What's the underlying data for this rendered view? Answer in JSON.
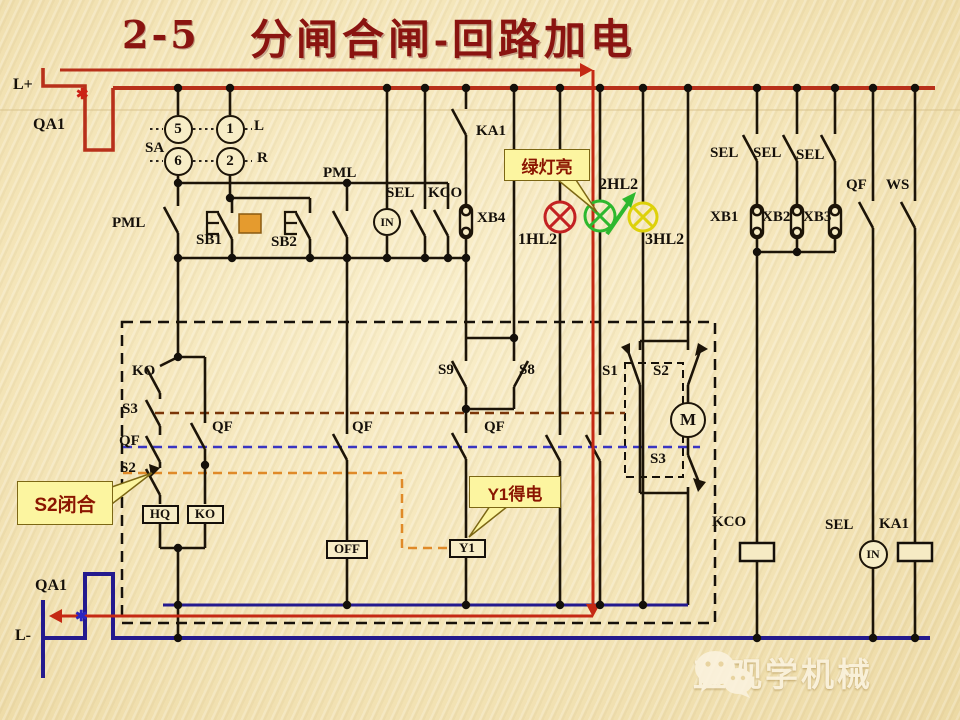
{
  "title": {
    "number": "2-5",
    "text": "分闸合闸-回路加电"
  },
  "callouts": {
    "green_lamp": "绿灯亮",
    "s2_closed": "S2闭合",
    "y1_energized": "Y1得电"
  },
  "watermark": {
    "text": "直观学机械",
    "icon": "wechat-icon"
  },
  "colors": {
    "background": "#f4e5b8",
    "title": "#8a1410",
    "positive_bus": "#b8301a",
    "negative_bus": "#241a8e",
    "wire": "#1c1408",
    "highlight_path": "#c52914",
    "callout_bg": "#fcf5a0",
    "callout_text": "#8b1500",
    "lamp_red": "#c32222",
    "lamp_green": "#2eb82e",
    "lamp_yellow": "#ddd10a",
    "dash_qf_link": "#3a35c2",
    "dash_s3_link": "#7a3508",
    "dash_s2_link": "#e08a28",
    "button_block": "#e59b2e"
  },
  "labels": [
    {
      "id": "l-plus",
      "text": "L+",
      "x": 13,
      "y": 77,
      "size": 16
    },
    {
      "id": "qa1-top",
      "text": "QA1",
      "x": 33,
      "y": 117,
      "size": 16
    },
    {
      "id": "sa",
      "text": "SA",
      "x": 145,
      "y": 141
    },
    {
      "id": "sa-pos-l",
      "text": "L",
      "x": 254,
      "y": 119
    },
    {
      "id": "sa-pos-r",
      "text": "R",
      "x": 257,
      "y": 151
    },
    {
      "id": "pml-left",
      "text": "PML",
      "x": 112,
      "y": 216
    },
    {
      "id": "sb1",
      "text": "SB1",
      "x": 196,
      "y": 233
    },
    {
      "id": "sb2",
      "text": "SB2",
      "x": 271,
      "y": 235
    },
    {
      "id": "pml-top",
      "text": "PML",
      "x": 323,
      "y": 166
    },
    {
      "id": "sel-mid",
      "text": "SEL",
      "x": 386,
      "y": 186
    },
    {
      "id": "kco-mid",
      "text": "KCO",
      "x": 428,
      "y": 186
    },
    {
      "id": "ka1-top",
      "text": "KA1",
      "x": 476,
      "y": 124
    },
    {
      "id": "xb4",
      "text": "XB4",
      "x": 477,
      "y": 211
    },
    {
      "id": "lamp1",
      "text": "1HL2",
      "x": 518,
      "y": 232,
      "size": 16
    },
    {
      "id": "lamp2",
      "text": "2HL2",
      "x": 599,
      "y": 177,
      "size": 16
    },
    {
      "id": "lamp3",
      "text": "3HL2",
      "x": 645,
      "y": 232,
      "size": 16
    },
    {
      "id": "sel-r1",
      "text": "SEL",
      "x": 710,
      "y": 146
    },
    {
      "id": "sel-r2",
      "text": "SEL",
      "x": 753,
      "y": 146
    },
    {
      "id": "sel-r3",
      "text": "SEL",
      "x": 796,
      "y": 148
    },
    {
      "id": "xb1",
      "text": "XB1",
      "x": 710,
      "y": 210
    },
    {
      "id": "xb2",
      "text": "XB2",
      "x": 762,
      "y": 210
    },
    {
      "id": "xb3",
      "text": "XB3",
      "x": 803,
      "y": 210
    },
    {
      "id": "qf-right",
      "text": "QF",
      "x": 846,
      "y": 178
    },
    {
      "id": "ws",
      "text": "WS",
      "x": 886,
      "y": 178
    },
    {
      "id": "ko-contact",
      "text": "KO",
      "x": 132,
      "y": 364
    },
    {
      "id": "s3-left",
      "text": "S3",
      "x": 122,
      "y": 402
    },
    {
      "id": "qf-left",
      "text": "QF",
      "x": 119,
      "y": 434
    },
    {
      "id": "s2-left",
      "text": "S2",
      "x": 120,
      "y": 461
    },
    {
      "id": "qf-midleft",
      "text": "QF",
      "x": 212,
      "y": 420
    },
    {
      "id": "qf-mid",
      "text": "QF",
      "x": 352,
      "y": 420
    },
    {
      "id": "s9",
      "text": "S9",
      "x": 438,
      "y": 363
    },
    {
      "id": "s8",
      "text": "S8",
      "x": 519,
      "y": 363
    },
    {
      "id": "qf-y1",
      "text": "QF",
      "x": 484,
      "y": 420
    },
    {
      "id": "s1",
      "text": "S1",
      "x": 602,
      "y": 364
    },
    {
      "id": "s2-right",
      "text": "S2",
      "x": 653,
      "y": 364
    },
    {
      "id": "s3-right",
      "text": "S3",
      "x": 650,
      "y": 452
    },
    {
      "id": "kco-bottom",
      "text": "KCO",
      "x": 712,
      "y": 515
    },
    {
      "id": "sel-bottom",
      "text": "SEL",
      "x": 825,
      "y": 518
    },
    {
      "id": "ka1-bottom",
      "text": "KA1",
      "x": 879,
      "y": 517
    },
    {
      "id": "qa1-bottom",
      "text": "QA1",
      "x": 35,
      "y": 578,
      "size": 16
    },
    {
      "id": "l-minus",
      "text": "L-",
      "x": 15,
      "y": 628,
      "size": 16
    },
    {
      "id": "break-mark-top",
      "text": "✱",
      "x": 76,
      "y": 88,
      "size": 15,
      "color": "#cc2015"
    },
    {
      "id": "break-mark-bottom",
      "text": "✱",
      "x": 75,
      "y": 610,
      "size": 15,
      "color": "#2b25c0"
    }
  ],
  "circle_components": [
    {
      "id": "sa-terminal-5",
      "text": "5",
      "x": 178,
      "y": 129,
      "d": 29
    },
    {
      "id": "sa-terminal-1",
      "text": "1",
      "x": 230,
      "y": 129,
      "d": 29
    },
    {
      "id": "sa-terminal-6",
      "text": "6",
      "x": 178,
      "y": 161,
      "d": 29
    },
    {
      "id": "sa-terminal-2",
      "text": "2",
      "x": 230,
      "y": 161,
      "d": 29
    },
    {
      "id": "in-relay-mid",
      "text": "IN",
      "x": 387,
      "y": 222,
      "d": 28,
      "f": 12
    },
    {
      "id": "motor",
      "text": "M",
      "x": 688,
      "y": 420,
      "d": 36,
      "f": 17
    },
    {
      "id": "in-relay-bottom",
      "text": "IN",
      "x": 873,
      "y": 554,
      "d": 29,
      "f": 12
    }
  ],
  "box_components": [
    {
      "id": "hq-coil",
      "text": "HQ",
      "x": 160,
      "y": 514,
      "w": 37
    },
    {
      "id": "ko-coil",
      "text": "KO",
      "x": 205,
      "y": 514,
      "w": 37
    },
    {
      "id": "off-coil",
      "text": "OFF",
      "x": 347,
      "y": 549,
      "w": 42
    },
    {
      "id": "y1-coil",
      "text": "Y1",
      "x": 467,
      "y": 548,
      "w": 37
    }
  ]
}
